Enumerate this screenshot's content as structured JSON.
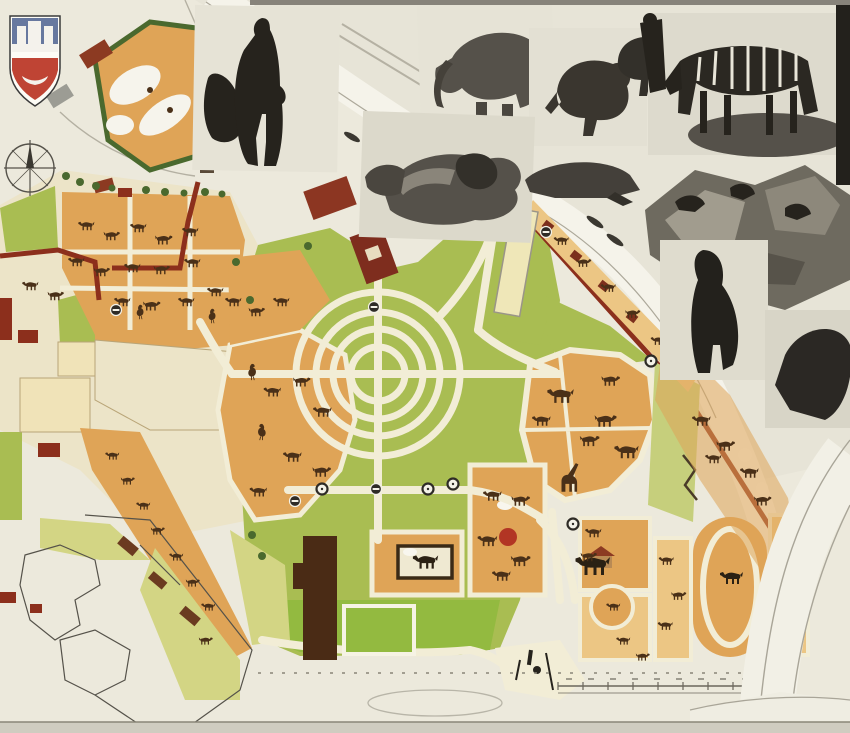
{
  "palette": {
    "paper": "#ece9dc",
    "photo_bg": "#e4e1d3",
    "photo_bg2": "#dbd8ca",
    "ink": "#3b3831",
    "photo_dark": "#26231d",
    "photo_mid": "#55514a",
    "photo_light": "#a8a396",
    "lawn": "#a9bd52",
    "lawn_bright": "#93ba40",
    "lawn_pale": "#c6cf7c",
    "slope": "#d3d584",
    "path": "#f2edd6",
    "road": "#f5f3ea",
    "tan": "#dfa457",
    "tan_light": "#ecc684",
    "cream": "#f0e3b8",
    "cream_pale": "#ece4c8",
    "wall": "#8c2f1c",
    "roof": "#8c3622",
    "dark_building": "#4a2b15",
    "hedge": "#4a692e",
    "animal": "#4a3018",
    "animal_dark": "#2b2114",
    "red_pond": "#b23524",
    "white": "#f8f6ee",
    "arms_blue": "#67789f",
    "arms_red": "#bf4434",
    "gray_line": "#a5a195",
    "scale_ink": "#6b675c"
  },
  "coat_of_arms": {
    "name": "belgrade-coat-of-arms"
  },
  "compass": {
    "name": "compass-rose"
  },
  "photos": [
    {
      "name": "standing-bear-photo"
    },
    {
      "name": "elephant-photo"
    },
    {
      "name": "bison-photo"
    },
    {
      "name": "bison-pair-photo"
    },
    {
      "name": "zebra-with-keeper-photo"
    },
    {
      "name": "lions-photo"
    },
    {
      "name": "sea-lion-photo"
    },
    {
      "name": "sea-lions-on-rocks-photo"
    },
    {
      "name": "standing-black-bear-photo"
    },
    {
      "name": "brown-bear-photo"
    }
  ],
  "map": {
    "features": [
      "polar-bear-enclosure",
      "circular-parterre-garden",
      "riding-oval",
      "sports-field",
      "sea-lion-pool",
      "fortress-walls",
      "entrance-building",
      "animal-pens"
    ],
    "scale_bar": {
      "ticks": 9
    },
    "markers": [
      {
        "x": 367,
        "y": 205,
        "kind": "ring"
      },
      {
        "x": 374,
        "y": 307,
        "kind": "dot"
      },
      {
        "x": 116,
        "y": 310,
        "kind": "dot"
      },
      {
        "x": 322,
        "y": 489,
        "kind": "ring"
      },
      {
        "x": 376,
        "y": 489,
        "kind": "dot"
      },
      {
        "x": 428,
        "y": 489,
        "kind": "ring"
      },
      {
        "x": 453,
        "y": 484,
        "kind": "ring"
      },
      {
        "x": 295,
        "y": 501,
        "kind": "dot"
      },
      {
        "x": 573,
        "y": 524,
        "kind": "ring"
      },
      {
        "x": 651,
        "y": 361,
        "kind": "ring"
      },
      {
        "x": 546,
        "y": 232,
        "kind": "dot"
      }
    ],
    "animals": [
      {
        "x": 86,
        "y": 226,
        "s": 0.7
      },
      {
        "x": 112,
        "y": 236,
        "s": 0.7,
        "f": 1
      },
      {
        "x": 138,
        "y": 228,
        "s": 0.7
      },
      {
        "x": 164,
        "y": 240,
        "s": 0.75,
        "f": 1
      },
      {
        "x": 190,
        "y": 232,
        "s": 0.7
      },
      {
        "x": 76,
        "y": 262,
        "s": 0.7
      },
      {
        "x": 102,
        "y": 272,
        "s": 0.7,
        "f": 1
      },
      {
        "x": 132,
        "y": 268,
        "s": 0.7
      },
      {
        "x": 162,
        "y": 270,
        "s": 0.7,
        "f": 1
      },
      {
        "x": 192,
        "y": 263,
        "s": 0.7
      },
      {
        "x": 215,
        "y": 292,
        "s": 0.7
      },
      {
        "x": 30,
        "y": 286,
        "s": 0.7
      },
      {
        "x": 56,
        "y": 296,
        "s": 0.7,
        "f": 1
      },
      {
        "x": 122,
        "y": 302,
        "s": 0.7
      },
      {
        "x": 152,
        "y": 306,
        "s": 0.75,
        "f": 1
      },
      {
        "x": 186,
        "y": 302,
        "s": 0.7
      },
      {
        "x": 140,
        "y": 312,
        "s": 0.8,
        "k": "b"
      },
      {
        "x": 212,
        "y": 316,
        "s": 0.8,
        "k": "b"
      },
      {
        "x": 233,
        "y": 302,
        "s": 0.7
      },
      {
        "x": 257,
        "y": 312,
        "s": 0.7,
        "f": 1
      },
      {
        "x": 281,
        "y": 302,
        "s": 0.7
      },
      {
        "x": 252,
        "y": 372,
        "s": 0.9,
        "k": "b"
      },
      {
        "x": 272,
        "y": 392,
        "s": 0.75
      },
      {
        "x": 302,
        "y": 382,
        "s": 0.75,
        "f": 1
      },
      {
        "x": 322,
        "y": 412,
        "s": 0.8
      },
      {
        "x": 262,
        "y": 432,
        "s": 0.9,
        "k": "b",
        "f": 1
      },
      {
        "x": 292,
        "y": 457,
        "s": 0.8
      },
      {
        "x": 322,
        "y": 472,
        "s": 0.8,
        "f": 1
      },
      {
        "x": 258,
        "y": 492,
        "s": 0.75
      },
      {
        "x": 112,
        "y": 456,
        "s": 0.6
      },
      {
        "x": 128,
        "y": 481,
        "s": 0.6,
        "f": 1
      },
      {
        "x": 143,
        "y": 506,
        "s": 0.6
      },
      {
        "x": 158,
        "y": 531,
        "s": 0.6,
        "f": 1
      },
      {
        "x": 176,
        "y": 557,
        "s": 0.6
      },
      {
        "x": 193,
        "y": 583,
        "s": 0.6,
        "f": 1
      },
      {
        "x": 208,
        "y": 607,
        "s": 0.6
      },
      {
        "x": 206,
        "y": 641,
        "s": 0.6,
        "f": 1
      },
      {
        "x": 560,
        "y": 396,
        "s": 1.15
      },
      {
        "x": 606,
        "y": 421,
        "s": 0.95,
        "f": 1
      },
      {
        "x": 626,
        "y": 452,
        "s": 1.05
      },
      {
        "x": 590,
        "y": 441,
        "s": 0.85,
        "f": 1
      },
      {
        "x": 541,
        "y": 421,
        "s": 0.8
      },
      {
        "x": 611,
        "y": 381,
        "s": 0.8,
        "f": 1
      },
      {
        "x": 568,
        "y": 480,
        "s": 1.3,
        "k": "g"
      },
      {
        "x": 492,
        "y": 496,
        "s": 0.8
      },
      {
        "x": 521,
        "y": 501,
        "s": 0.8,
        "f": 1
      },
      {
        "x": 487,
        "y": 541,
        "s": 0.85
      },
      {
        "x": 521,
        "y": 561,
        "s": 0.85,
        "f": 1
      },
      {
        "x": 501,
        "y": 576,
        "s": 0.8
      },
      {
        "x": 425,
        "y": 562,
        "s": 1.1,
        "c": "d"
      },
      {
        "x": 592,
        "y": 566,
        "s": 1.5,
        "c": "d"
      },
      {
        "x": 731,
        "y": 578,
        "s": 1.0,
        "c": "d"
      },
      {
        "x": 666,
        "y": 561,
        "s": 0.65
      },
      {
        "x": 679,
        "y": 596,
        "s": 0.65,
        "f": 1
      },
      {
        "x": 665,
        "y": 626,
        "s": 0.65
      },
      {
        "x": 613,
        "y": 607,
        "s": 0.6
      },
      {
        "x": 593,
        "y": 533,
        "s": 0.7
      },
      {
        "x": 589,
        "y": 557,
        "s": 0.7,
        "f": 1
      },
      {
        "x": 783,
        "y": 541,
        "s": 0.6
      },
      {
        "x": 793,
        "y": 579,
        "s": 0.6,
        "f": 1
      },
      {
        "x": 784,
        "y": 619,
        "s": 0.6
      },
      {
        "x": 794,
        "y": 649,
        "s": 0.6,
        "f": 1
      },
      {
        "x": 623,
        "y": 641,
        "s": 0.6
      },
      {
        "x": 643,
        "y": 657,
        "s": 0.6,
        "f": 1
      },
      {
        "x": 561,
        "y": 241,
        "s": 0.65
      },
      {
        "x": 584,
        "y": 263,
        "s": 0.65,
        "f": 1
      },
      {
        "x": 608,
        "y": 288,
        "s": 0.65
      },
      {
        "x": 633,
        "y": 314,
        "s": 0.65,
        "f": 1
      },
      {
        "x": 658,
        "y": 341,
        "s": 0.65
      },
      {
        "x": 701,
        "y": 421,
        "s": 0.8
      },
      {
        "x": 726,
        "y": 446,
        "s": 0.8,
        "f": 1
      },
      {
        "x": 749,
        "y": 473,
        "s": 0.8
      },
      {
        "x": 763,
        "y": 501,
        "s": 0.75,
        "f": 1
      },
      {
        "x": 713,
        "y": 459,
        "s": 0.7
      }
    ]
  }
}
